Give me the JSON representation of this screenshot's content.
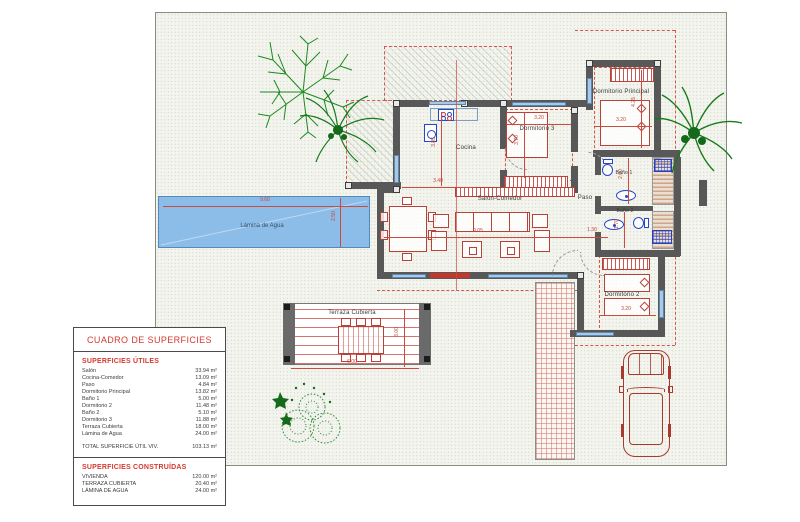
{
  "table": {
    "title": "CUADRO DE SUPERFICIES",
    "utiles": {
      "heading": "SUPERFICIES ÚTILES",
      "rows": [
        {
          "label": "Salón",
          "value": "33.94 m²"
        },
        {
          "label": "Cocina-Comedor",
          "value": "13.09 m²"
        },
        {
          "label": "Paso",
          "value": "4.84 m²"
        },
        {
          "label": "Dormitorio Principal",
          "value": "13.82 m²"
        },
        {
          "label": "Baño 1",
          "value": "5.00 m²"
        },
        {
          "label": "Dormitorio 2",
          "value": "11.48 m²"
        },
        {
          "label": "Baño 2",
          "value": "5.10 m²"
        },
        {
          "label": "Dormitorio 3",
          "value": "11.88 m²"
        },
        {
          "label": "Terraza Cubierta",
          "value": "18.00 m²"
        },
        {
          "label": "Lámina de Agua",
          "value": "24.00 m²"
        }
      ],
      "total_label": "TOTAL SUPERFICIE ÚTIL VIV.",
      "total_value": "103.13 m²"
    },
    "construidas": {
      "heading": "SUPERFICIES CONSTRUÍDAS",
      "rows": [
        {
          "label": "VIVIENDA",
          "value": "120.00 m²"
        },
        {
          "label": "TERRAZA CUBIERTA",
          "value": "20.40 m²"
        },
        {
          "label": "LÁMINA DE AGUA",
          "value": "24.00 m²"
        }
      ]
    }
  },
  "plan": {
    "rooms": {
      "cocina": "Cocina",
      "dorm3": "Dormitorio 3",
      "dormp": "Dormitorio Principal",
      "salon": "Salón-Comedor",
      "paso": "Paso",
      "bano1": "Baño 1",
      "bano2": "Baño 2",
      "dorm2": "Dormitorio 2",
      "terraza": "Terraza Cubierta",
      "lamina": "Lámina de Agua"
    },
    "dims": {
      "pool_w": "9.60",
      "pool_h": "2.50",
      "cocina_w": "3.40",
      "cocina_h": "3.85",
      "salon_w": "9.05",
      "paso_w": "1.30",
      "dorm3_w": "3.20",
      "dorm3_h": "3.70",
      "dormp_w": "3.20",
      "dormp_h": "4.25",
      "bano1_h": "2.00",
      "bano2_h": "1.70",
      "dorm2_w": "3.20",
      "terraza_w": "6.00",
      "terraza_h": "3.00"
    }
  },
  "colors": {
    "accent_red": "#d33a2f",
    "wall_gray": "#585858",
    "pool_blue": "#8cbde8",
    "plant_green": "#1c8a1f",
    "fixture_blue": "#2847c8"
  }
}
